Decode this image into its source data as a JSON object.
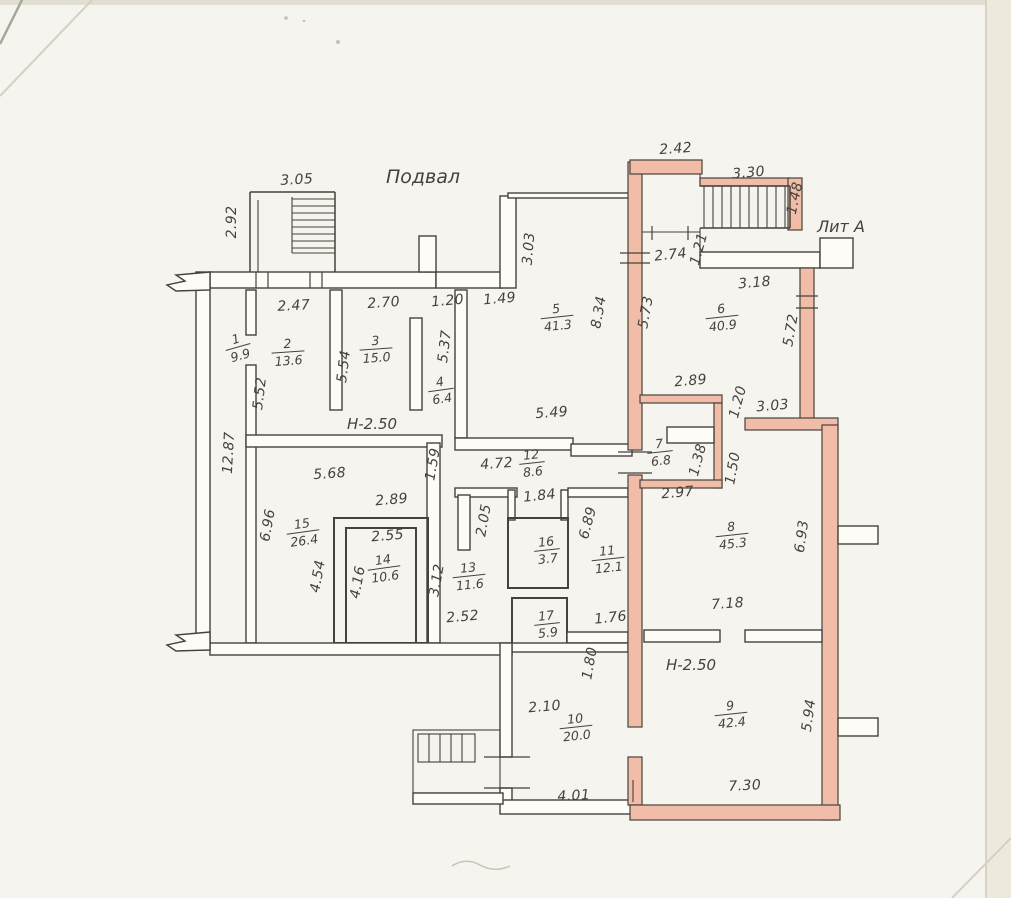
{
  "drawing": {
    "title": "Подвал",
    "building_label": "Лит А",
    "height_notes": [
      {
        "text": "Н-2.50",
        "x": 372,
        "y": 429,
        "size": 15
      },
      {
        "text": "Н-2.50",
        "x": 691,
        "y": 670,
        "size": 17
      }
    ],
    "rooms": [
      {
        "n": "1",
        "area": "9.9",
        "x": 238,
        "y": 347,
        "rot": -16
      },
      {
        "n": "2",
        "area": "13.6",
        "x": 288,
        "y": 352,
        "rot": -4
      },
      {
        "n": "3",
        "area": "15.0",
        "x": 376,
        "y": 349,
        "rot": -4
      },
      {
        "n": "4",
        "area": "6.4",
        "x": 441,
        "y": 390,
        "rot": -8
      },
      {
        "n": "5",
        "area": "41.3",
        "x": 557,
        "y": 317,
        "rot": -6
      },
      {
        "n": "6",
        "area": "40.9",
        "x": 722,
        "y": 317,
        "rot": -6
      },
      {
        "n": "7",
        "area": "6.8",
        "x": 660,
        "y": 452,
        "rot": -6
      },
      {
        "n": "8",
        "area": "45.3",
        "x": 732,
        "y": 535,
        "rot": -6
      },
      {
        "n": "9",
        "area": "42.4",
        "x": 731,
        "y": 714,
        "rot": -6
      },
      {
        "n": "10",
        "area": "20.0",
        "x": 576,
        "y": 727,
        "rot": -6
      },
      {
        "n": "11",
        "area": "12.1",
        "x": 608,
        "y": 559,
        "rot": -6
      },
      {
        "n": "12",
        "area": "8.6",
        "x": 532,
        "y": 463,
        "rot": -6
      },
      {
        "n": "13",
        "area": "11.6",
        "x": 469,
        "y": 576,
        "rot": -6
      },
      {
        "n": "14",
        "area": "10.6",
        "x": 384,
        "y": 568,
        "rot": -8
      },
      {
        "n": "15",
        "area": "26.4",
        "x": 303,
        "y": 532,
        "rot": -8
      },
      {
        "n": "16",
        "area": "3.7",
        "x": 547,
        "y": 550,
        "rot": -6
      },
      {
        "n": "17",
        "area": "5.9",
        "x": 547,
        "y": 624,
        "rot": -6
      }
    ],
    "dimensions": [
      {
        "v": "3.05",
        "x": 297,
        "y": 184,
        "rot": -3
      },
      {
        "v": "2.92",
        "x": 236,
        "y": 222,
        "rot": -90
      },
      {
        "v": "2.42",
        "x": 676,
        "y": 153,
        "rot": -4
      },
      {
        "v": "3.30",
        "x": 749,
        "y": 177,
        "rot": -5
      },
      {
        "v": "1.48",
        "x": 799,
        "y": 199,
        "rot": -78
      },
      {
        "v": "2.74",
        "x": 671,
        "y": 259,
        "rot": -6
      },
      {
        "v": "1.21",
        "x": 703,
        "y": 250,
        "rot": -75
      },
      {
        "v": "3.18",
        "x": 755,
        "y": 287,
        "rot": -5
      },
      {
        "v": "2.47",
        "x": 294,
        "y": 310,
        "rot": -3
      },
      {
        "v": "2.70",
        "x": 384,
        "y": 307,
        "rot": -4
      },
      {
        "v": "1.20",
        "x": 448,
        "y": 305,
        "rot": -5
      },
      {
        "v": "1.49",
        "x": 500,
        "y": 303,
        "rot": -5
      },
      {
        "v": "3.03",
        "x": 533,
        "y": 249,
        "rot": -85
      },
      {
        "v": "8.34",
        "x": 603,
        "y": 313,
        "rot": -80
      },
      {
        "v": "5.73",
        "x": 650,
        "y": 313,
        "rot": -80
      },
      {
        "v": "5.72",
        "x": 795,
        "y": 331,
        "rot": -80
      },
      {
        "v": "5.54",
        "x": 348,
        "y": 367,
        "rot": -83
      },
      {
        "v": "5.37",
        "x": 449,
        "y": 347,
        "rot": -83
      },
      {
        "v": "5.52",
        "x": 264,
        "y": 394,
        "rot": -83
      },
      {
        "v": "12.87",
        "x": 233,
        "y": 453,
        "rot": -87
      },
      {
        "v": "2.89",
        "x": 691,
        "y": 385,
        "rot": -5
      },
      {
        "v": "1.20",
        "x": 742,
        "y": 403,
        "rot": -75
      },
      {
        "v": "3.03",
        "x": 773,
        "y": 410,
        "rot": -5
      },
      {
        "v": "5.49",
        "x": 552,
        "y": 417,
        "rot": -4
      },
      {
        "v": "4.72",
        "x": 497,
        "y": 468,
        "rot": -4
      },
      {
        "v": "1.59",
        "x": 437,
        "y": 465,
        "rot": -80
      },
      {
        "v": "5.68",
        "x": 330,
        "y": 478,
        "rot": -4
      },
      {
        "v": "2.89",
        "x": 392,
        "y": 504,
        "rot": -5
      },
      {
        "v": "1.84",
        "x": 540,
        "y": 500,
        "rot": -6
      },
      {
        "v": "2.05",
        "x": 488,
        "y": 521,
        "rot": -80
      },
      {
        "v": "6.89",
        "x": 592,
        "y": 524,
        "rot": -75
      },
      {
        "v": "2.97",
        "x": 678,
        "y": 497,
        "rot": -5
      },
      {
        "v": "1.38",
        "x": 702,
        "y": 461,
        "rot": -75
      },
      {
        "v": "1.50",
        "x": 737,
        "y": 469,
        "rot": -80
      },
      {
        "v": "6.96",
        "x": 272,
        "y": 526,
        "rot": -80
      },
      {
        "v": "2.55",
        "x": 388,
        "y": 540,
        "rot": -5
      },
      {
        "v": "4.54",
        "x": 322,
        "y": 577,
        "rot": -80
      },
      {
        "v": "4.16",
        "x": 362,
        "y": 583,
        "rot": -80
      },
      {
        "v": "3.12",
        "x": 441,
        "y": 581,
        "rot": -80
      },
      {
        "v": "6.93",
        "x": 806,
        "y": 537,
        "rot": -82
      },
      {
        "v": "2.52",
        "x": 463,
        "y": 621,
        "rot": -5
      },
      {
        "v": "1.76",
        "x": 611,
        "y": 622,
        "rot": -6
      },
      {
        "v": "7.18",
        "x": 728,
        "y": 608,
        "rot": -4
      },
      {
        "v": "1.80",
        "x": 594,
        "y": 664,
        "rot": -80
      },
      {
        "v": "2.10",
        "x": 545,
        "y": 711,
        "rot": -5
      },
      {
        "v": "5.94",
        "x": 813,
        "y": 716,
        "rot": -82
      },
      {
        "v": "4.01",
        "x": 574,
        "y": 800,
        "rot": -3
      },
      {
        "v": "7.30",
        "x": 745,
        "y": 790,
        "rot": -3
      }
    ],
    "colors": {
      "paper": "#f6f4ee",
      "ink": "#45423c",
      "highlight": "#f1bda8"
    }
  }
}
